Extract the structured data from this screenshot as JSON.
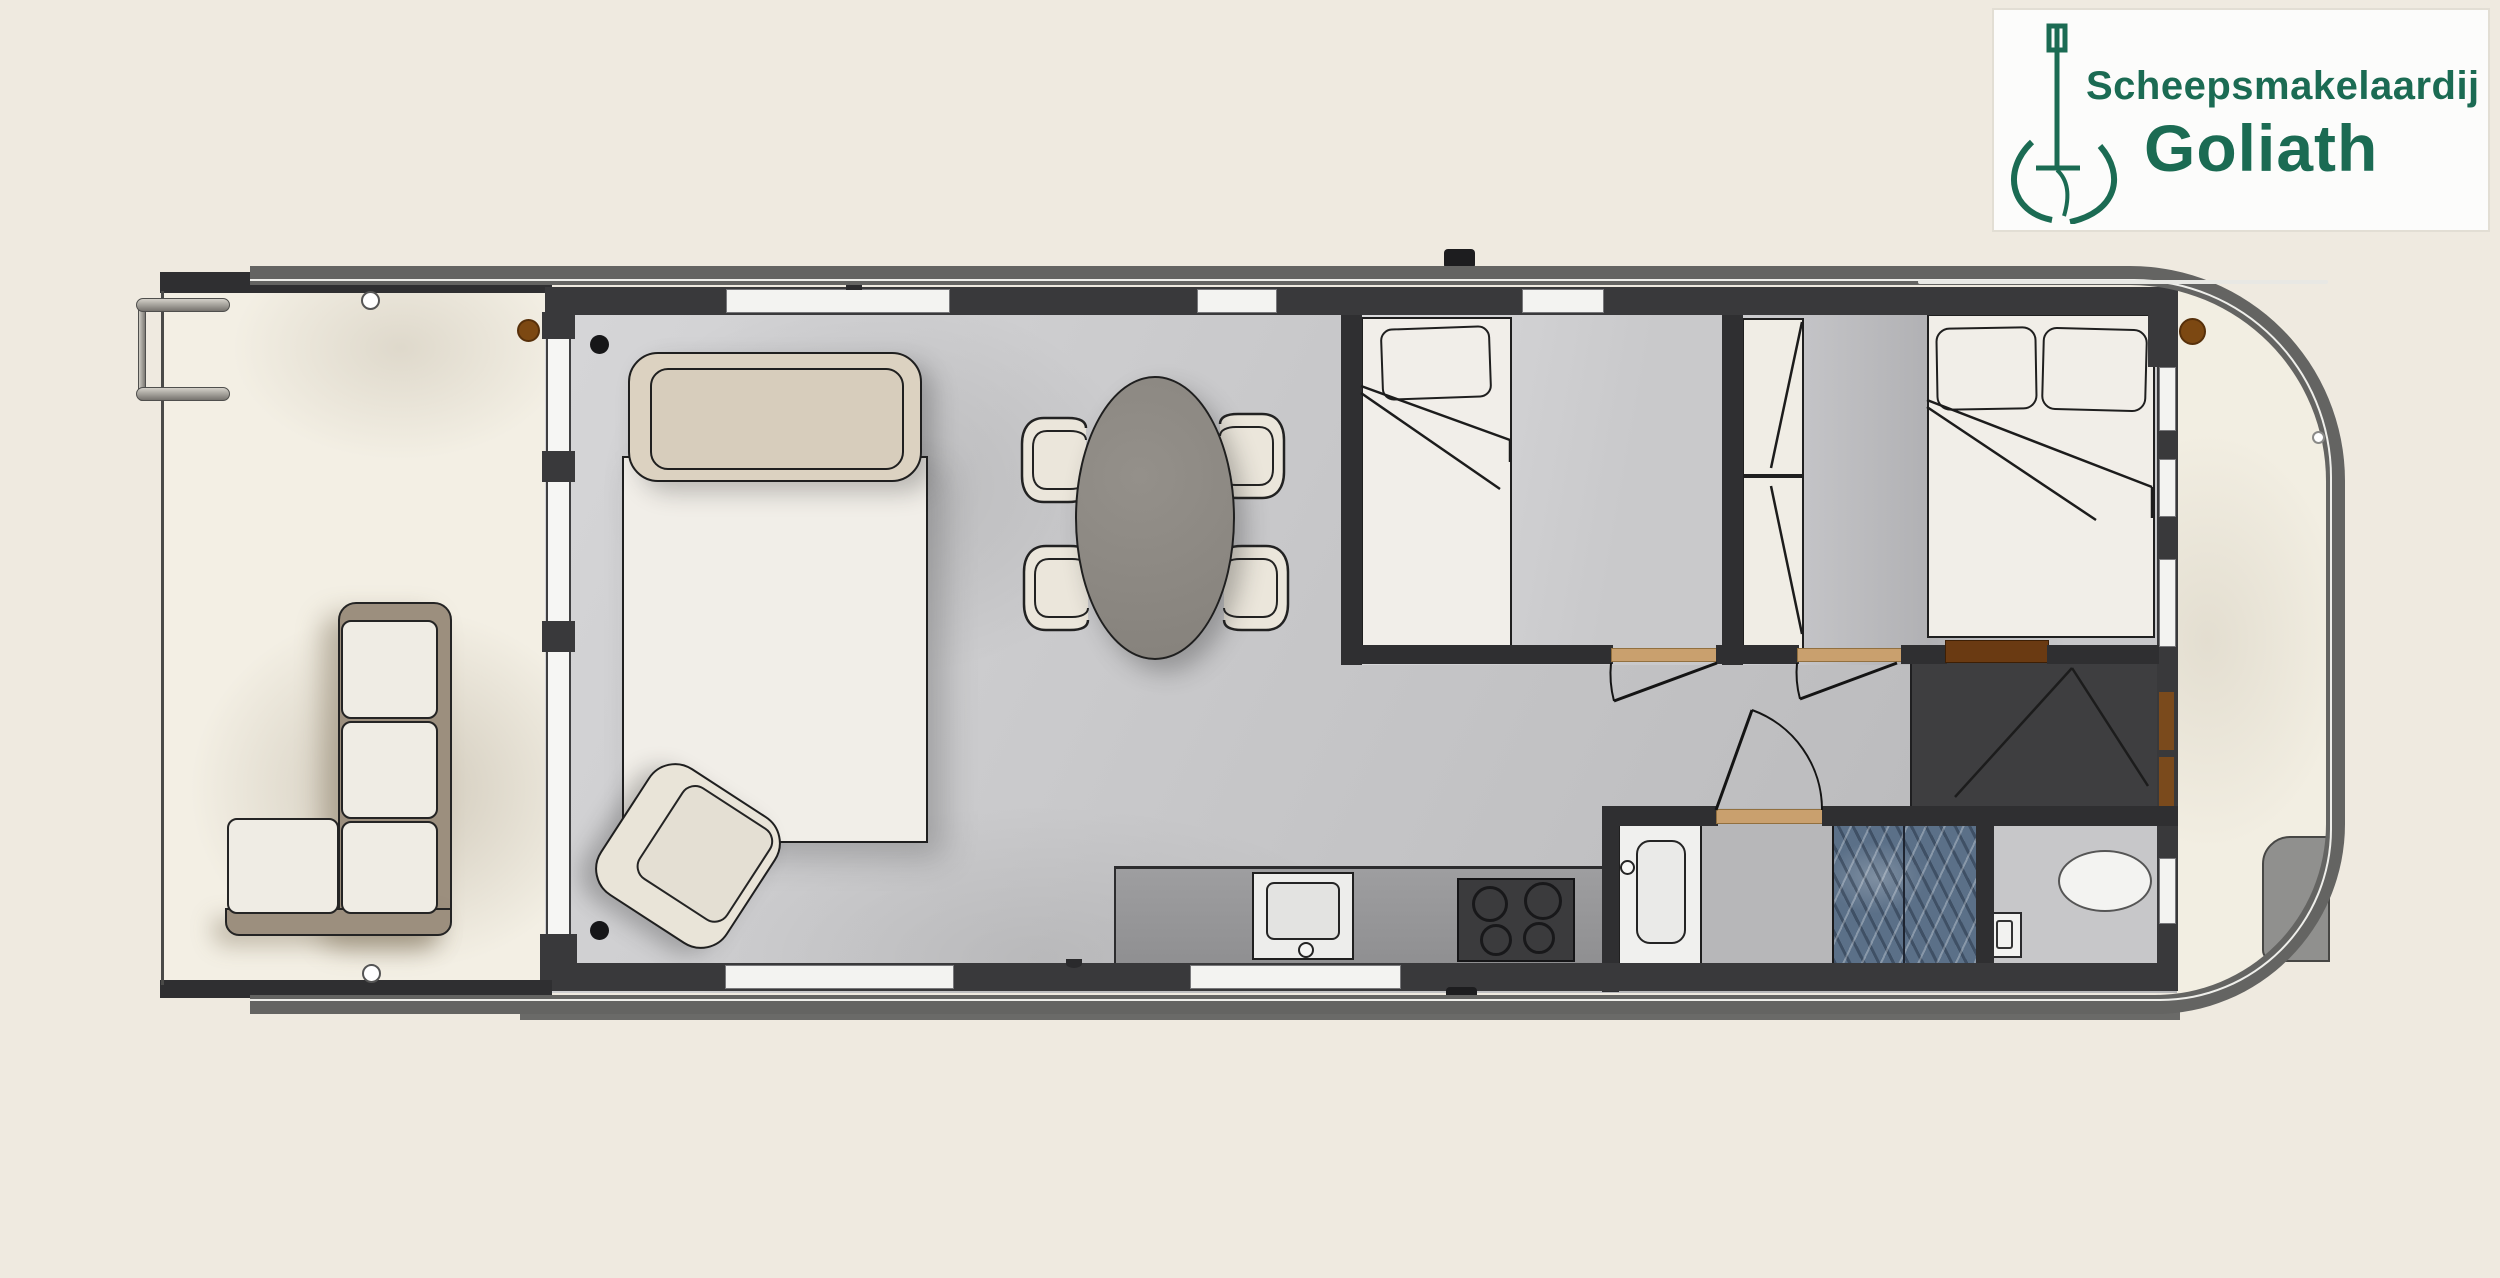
{
  "logo": {
    "line1": "Scheepsmakelaardij",
    "line2": "Goliath",
    "brand_color": "#1b6b53",
    "icon": "goliath-crane-anchor-icon",
    "card_background": "#fcfcfb"
  },
  "plan": {
    "type": "houseboat-floor-plan",
    "orientation": "bow-right-stern-left",
    "colors": {
      "background": "#efeae0",
      "deck_floor": "#f3efe4",
      "interior_floor": "#c7c7c9",
      "walls": "#39393b",
      "hull_rim": "#646462",
      "window": "#f3f3f1",
      "threshold_wood": "#c9a06e",
      "dark_wood_niche": "#6a3a12",
      "furniture_cream": "#f1eee8",
      "sofa_frame_taupe": "#9c8f7e",
      "headboard_tan": "#dcd2c1",
      "table_gray": "#8b8781",
      "shower_tile_blue": "#5b7088",
      "closet_dark": "#3e3e40"
    },
    "rooms": [
      {
        "name": "aft-deck",
        "features": [
          "l-shaped-sofa",
          "boarding-ladder",
          "glass-partition"
        ]
      },
      {
        "name": "living-room",
        "features": [
          "daybed",
          "armchair",
          "dining-table",
          "4-chairs"
        ]
      },
      {
        "name": "galley",
        "features": [
          "counter",
          "sink",
          "stove-4-burners"
        ]
      },
      {
        "name": "cabin-single",
        "features": [
          "single-bed",
          "door"
        ]
      },
      {
        "name": "cabin-double",
        "features": [
          "double-bed",
          "wardrobe",
          "door"
        ]
      },
      {
        "name": "bathroom",
        "features": [
          "washbasin",
          "shower",
          "door"
        ]
      },
      {
        "name": "toilet-room",
        "features": [
          "toilet",
          "cistern"
        ]
      },
      {
        "name": "technical-closet",
        "features": [
          "double-doors",
          "shelving"
        ]
      },
      {
        "name": "bow-deck",
        "features": [
          "railing",
          "deck-hatch"
        ]
      }
    ],
    "counts": {
      "dining_chairs": 4,
      "stove_burners": 4,
      "sofa_cushions": 4,
      "beds": 3,
      "top_windows": 3,
      "bottom_windows": 2,
      "side_windows": 4,
      "portholes": 2,
      "doors_with_swing_arc": 4
    }
  }
}
